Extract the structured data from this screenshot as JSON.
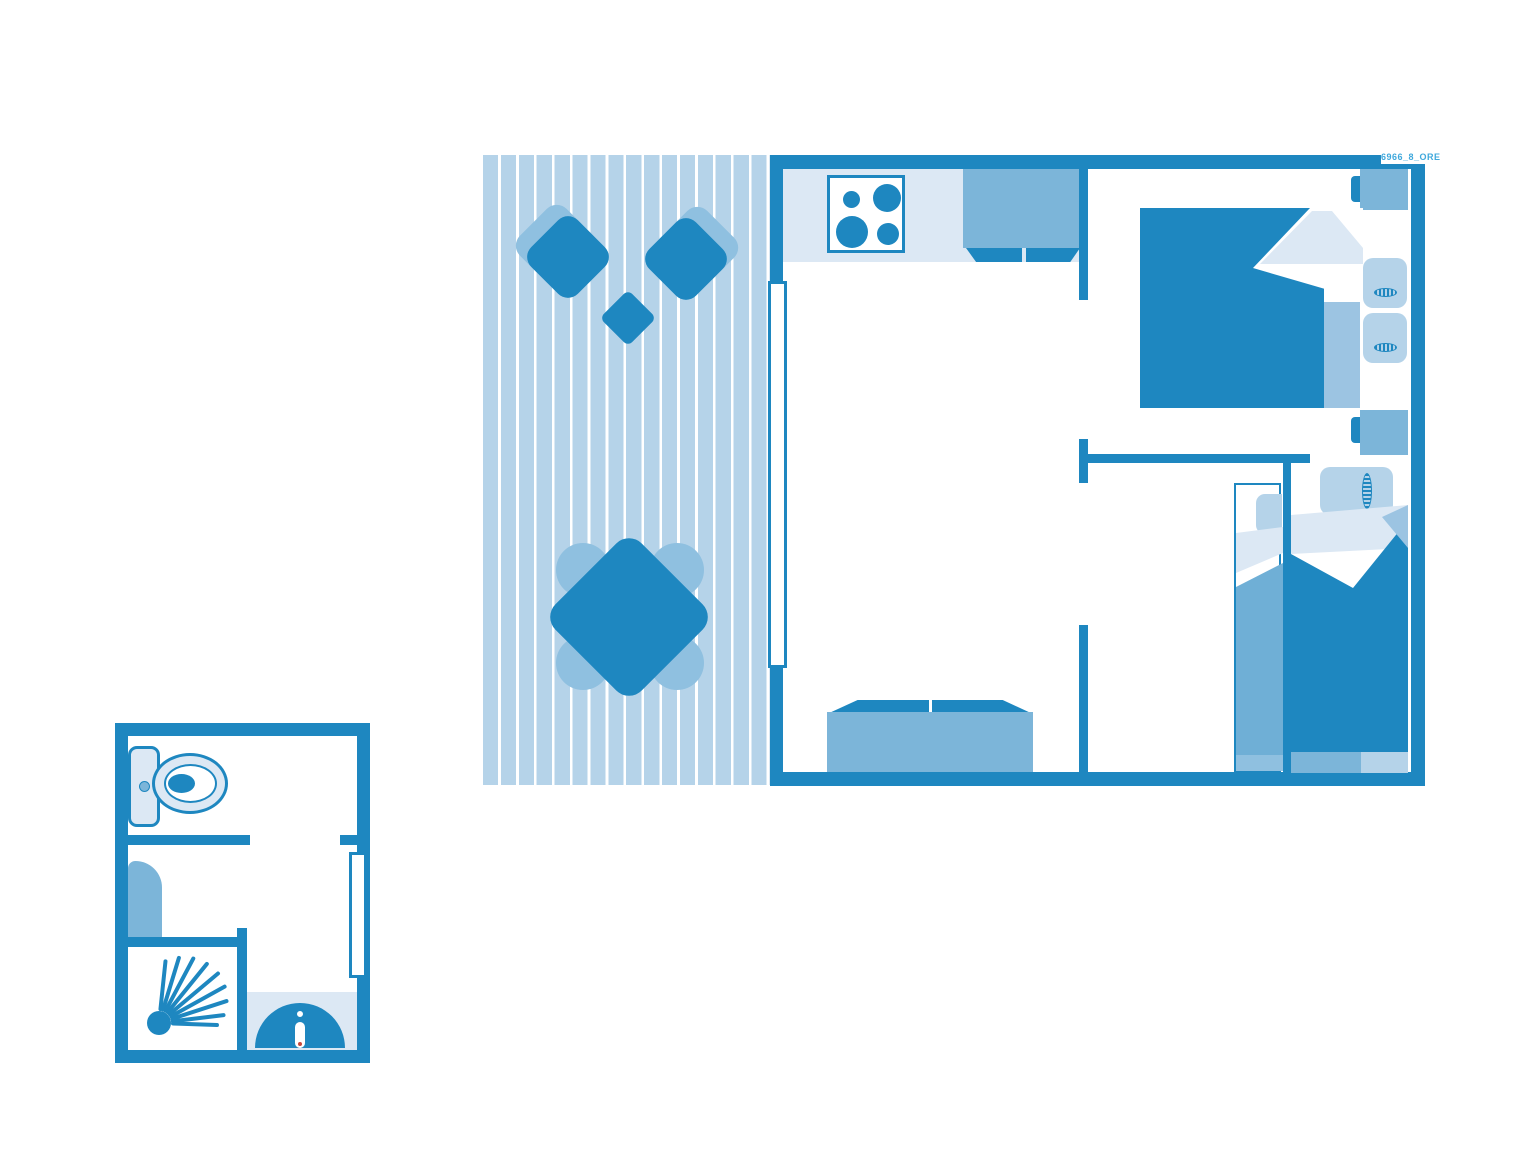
{
  "watermark": "6966_8_ORE",
  "colors": {
    "wall": "#1E87C0",
    "medium": "#7CB5D9",
    "light": "#B5D3E9",
    "pale": "#DCE8F4",
    "chairback": "#8FC0E0",
    "foldmid": "#9CC4E2",
    "blanket2": "#6FAFD6",
    "footlight": "#8FC0E0",
    "watermark": "#3FA8DC",
    "faucetdot": "#C8473C"
  },
  "plan": {
    "deck": {
      "name": "terrace-deck",
      "furniture": [
        "lounge-chair",
        "lounge-chair",
        "side-table",
        "dining-table",
        "dining-chair",
        "dining-chair",
        "dining-chair",
        "dining-chair"
      ]
    },
    "main_unit": {
      "rooms": [
        "kitchen-living-room",
        "master-bedroom",
        "single-bedroom-left",
        "single-bedroom-right"
      ],
      "kitchen": {
        "furniture": [
          "stove-hob",
          "kitchen-cabinet",
          "counter"
        ]
      },
      "living": {
        "furniture": [
          "sofa",
          "sliding-door"
        ]
      },
      "master_bedroom": {
        "furniture": [
          "double-bed",
          "pillow",
          "pillow",
          "nightstand",
          "nightstand"
        ]
      },
      "single_bedroom_left": {
        "furniture": [
          "single-bed",
          "pillow"
        ]
      },
      "single_bedroom_right": {
        "furniture": [
          "single-bed",
          "pillow",
          "foot-bench"
        ]
      }
    },
    "bathroom_unit": {
      "rooms": [
        "wc",
        "shower-room"
      ],
      "furniture": [
        "toilet",
        "water-heater",
        "shower",
        "washbasin",
        "door"
      ]
    }
  }
}
